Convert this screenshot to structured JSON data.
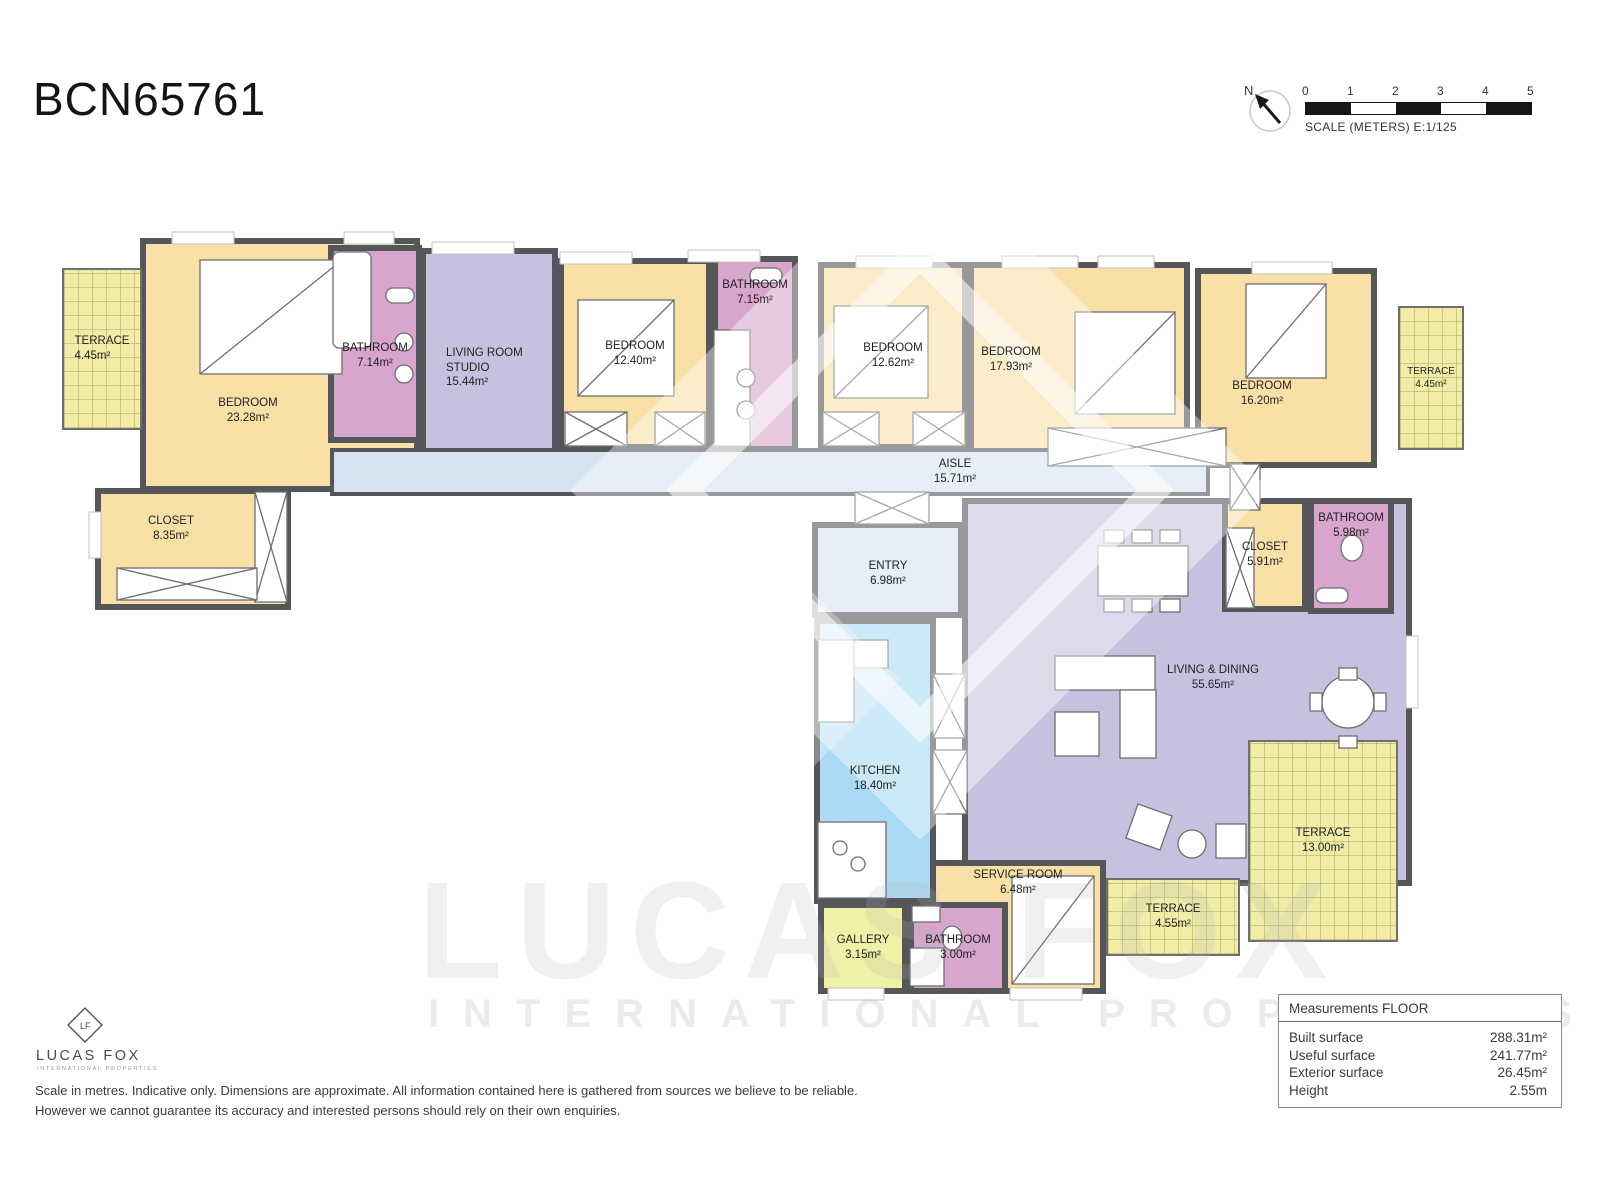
{
  "title": "BCN65761",
  "colors": {
    "bedroom": "#f8e0a7",
    "bathroom": "#d8a5cc",
    "living": "#c7c1e0",
    "aisle": "#d6e4f2",
    "kitchen": "#aadaf4",
    "terrace": "#f1eda8",
    "gallery": "#eef1a6",
    "wall": "#55565a"
  },
  "compass": {
    "north_label": "N"
  },
  "scale_bar": {
    "ticks": [
      "0",
      "1",
      "2",
      "3",
      "4",
      "5"
    ],
    "caption": "SCALE (METERS) E:1/125"
  },
  "rooms": [
    {
      "name": "TERRACE",
      "area": "4.45m²"
    },
    {
      "name": "BEDROOM",
      "area": "23.28m²"
    },
    {
      "name": "BATHROOM",
      "area": "7.14m²"
    },
    {
      "name": "LIVING ROOM STUDIO",
      "area": "15.44m²"
    },
    {
      "name": "BEDROOM",
      "area": "12.40m²"
    },
    {
      "name": "BATHROOM",
      "area": "7.15m²"
    },
    {
      "name": "BEDROOM",
      "area": "12.62m²"
    },
    {
      "name": "BEDROOM",
      "area": "17.93m²"
    },
    {
      "name": "BEDROOM",
      "area": "16.20m²"
    },
    {
      "name": "TERRACE",
      "area": "4.45m²"
    },
    {
      "name": "AISLE",
      "area": "15.71m²"
    },
    {
      "name": "CLOSET",
      "area": "8.35m²"
    },
    {
      "name": "ENTRY",
      "area": "6.98m²"
    },
    {
      "name": "CLOSET",
      "area": "5.91m²"
    },
    {
      "name": "BATHROOM",
      "area": "5.98m²"
    },
    {
      "name": "LIVING & DINING",
      "area": "55.65m²"
    },
    {
      "name": "KITCHEN",
      "area": "18.40m²"
    },
    {
      "name": "TERRACE",
      "area": "13.00m²"
    },
    {
      "name": "SERVICE ROOM",
      "area": "6.48m²"
    },
    {
      "name": "GALLERY",
      "area": "3.15m²"
    },
    {
      "name": "BATHROOM",
      "area": "3.00m²"
    },
    {
      "name": "TERRACE",
      "area": "4.55m²"
    }
  ],
  "watermark": {
    "brand": "LUCAS FOX",
    "subbrand": "INTERNATIONAL PROPERTIES"
  },
  "logo": {
    "monogram": "LF",
    "brand": "LUCAS FOX",
    "subtitle": "INTERNATIONAL PROPERTIES"
  },
  "disclaimer": {
    "line1": "Scale in metres. Indicative only. Dimensions are approximate. All information contained here is gathered from sources we believe to be reliable.",
    "line2": "However we cannot guarantee its accuracy and interested persons should rely on their own enquiries."
  },
  "measurements": {
    "header": "Measurements FLOOR",
    "rows": [
      {
        "label": "Built surface",
        "value": "288.31m²"
      },
      {
        "label": "Useful surface",
        "value": "241.77m²"
      },
      {
        "label": "Exterior surface",
        "value": "26.45m²"
      },
      {
        "label": "Height",
        "value": "2.55m"
      }
    ]
  }
}
